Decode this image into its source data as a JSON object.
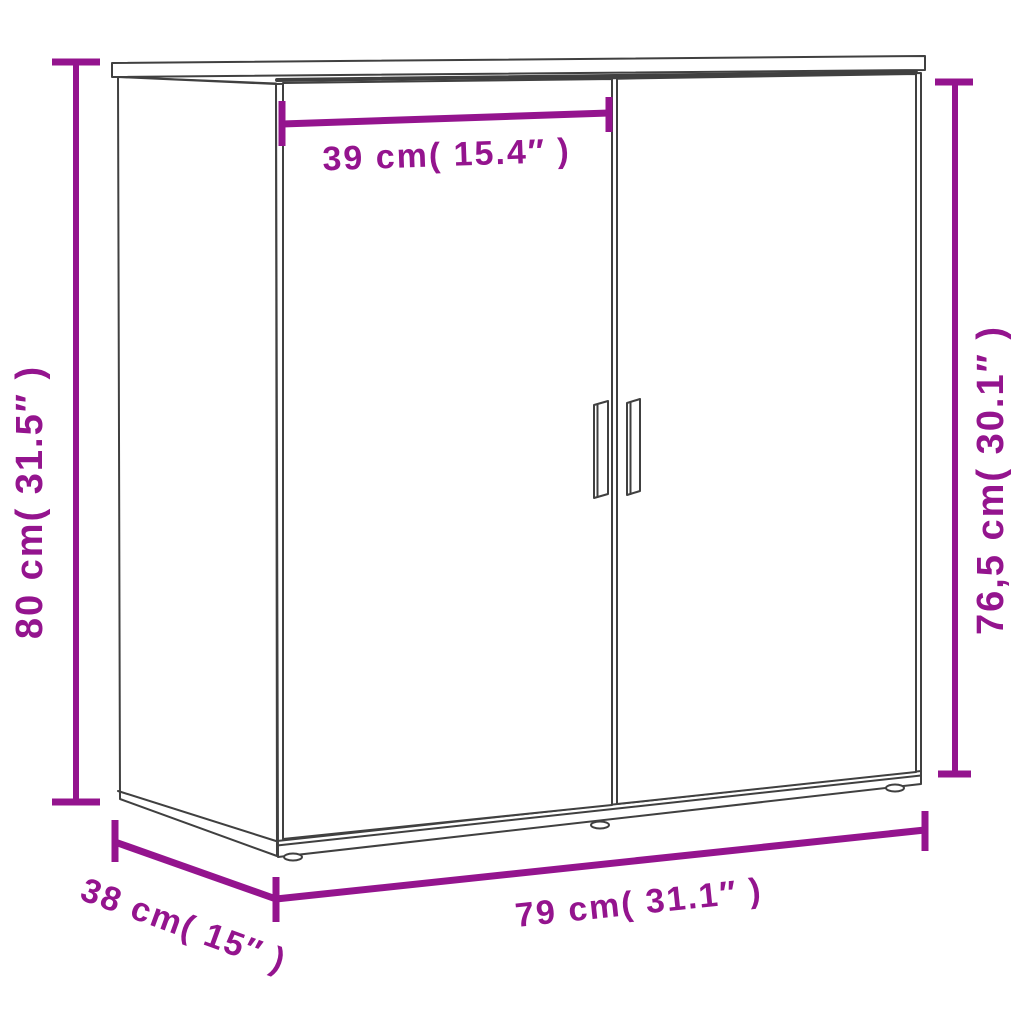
{
  "colors": {
    "dimension": "#94148e",
    "outline": "#404040",
    "background": "#ffffff"
  },
  "dimensions": {
    "door_width": "39 cm( 15.4″ )",
    "height_left": "80 cm( 31.5″ )",
    "height_right": "76,5 cm( 30.1″ )",
    "depth": "38 cm( 15″ )",
    "length": "79 cm( 31.1″ )"
  }
}
